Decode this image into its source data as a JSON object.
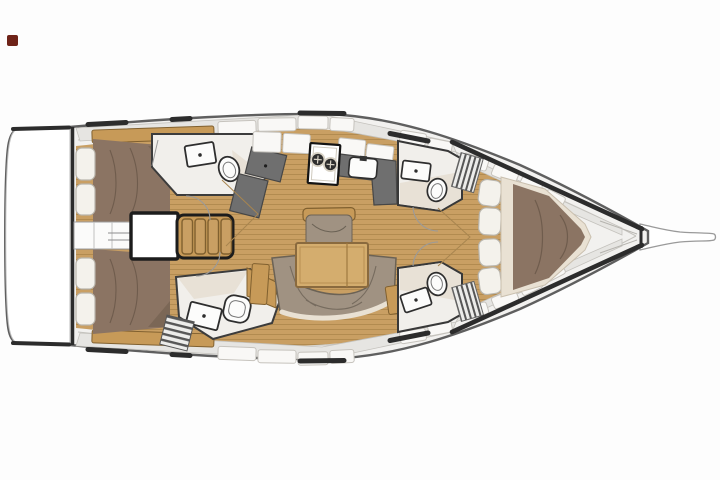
{
  "meta": {
    "title": "Sailing yacht interior layout floor plan",
    "view": "top-down",
    "bow_direction": "right"
  },
  "canvas": {
    "width": 720,
    "height": 480,
    "background": "#fdfdfd"
  },
  "colors": {
    "page_bg": "#fdfdfd",
    "hull_fill": "#f2f1ef",
    "hull_stroke": "#5f5f5f",
    "hull_dash": "#2c2c2c",
    "deck_band": "#e6e5e2",
    "band_edge": "#c4c2bd",
    "panel_white": "#f9f8f6",
    "panel_border": "#c6c3bd",
    "wood_base": "#c99f63",
    "wood_stripe": "#ab8449",
    "wood_trim": "#c79a58",
    "wood_trim_border": "#80602f",
    "mattress": "#8b7463",
    "mattress_shadow": "#6f5c4d",
    "bedding_cream": "#e9e1d3",
    "pillow": "#f4f2ec",
    "pillow_border": "#b9b5ac",
    "sofa": "#a09282",
    "sofa_border": "#6b6255",
    "counter_dark": "#6f6f6f",
    "counter_border": "#464646",
    "fixture_white": "#fcfcfb",
    "fixture_outline": "#2e2e2e",
    "bath_floor": "#f1efeb",
    "bath_floor_warm": "#e8e1d6",
    "slat_light": "#ececea",
    "slat_dark": "#565656",
    "thin_line": "#9a9a9a",
    "floor_mark": "#a8854f",
    "marker_red": "#6e2318",
    "transom_white": "#ffffff",
    "table_top": "#d4ad6e",
    "table_border": "#8a6a3e"
  },
  "plan": {
    "type": "yacht-floor-plan",
    "layout_summary": "3 cabins, 4 heads, saloon, galley, nav station",
    "rooms": [
      "swim-platform-transom",
      "aft-cabin-starboard",
      "aft-cabin-port",
      "engine-compartment",
      "companionway-stairs",
      "head-aft-starboard",
      "head-aft-port",
      "nav-station",
      "galley",
      "saloon",
      "head-forward-starboard",
      "head-forward-port",
      "forward-cabin",
      "anchor-locker",
      "bowsprit"
    ],
    "features": {
      "cabins": 3,
      "heads": 4,
      "stove_burners": 2,
      "companionway_treads": 4,
      "forward_berth_pillows": 4,
      "aft_cabin_pillows_each": 2,
      "hull_window_dashes_per_side": 3
    }
  }
}
